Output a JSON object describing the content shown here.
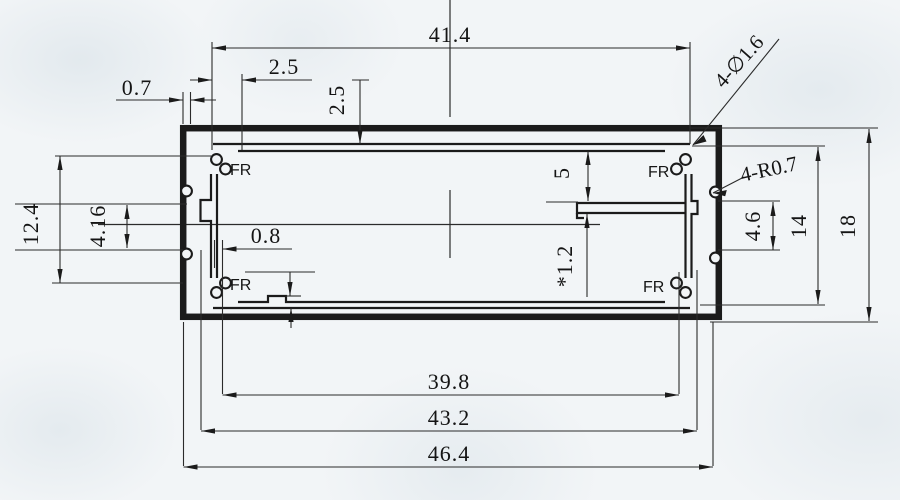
{
  "drawing": {
    "title": "aluminum extrusion enclosure profile cross-section",
    "labels": {
      "corner_boss": "FR"
    },
    "dims": {
      "top_width": "41.4",
      "top_inset": "2.5",
      "top_depth": "2.5",
      "wall_thickness": "0.7",
      "corner_holes": "4-∅1.6",
      "side_ribs": "4-R0.7",
      "left_inner_height": "12.4",
      "rib_gap": "4.16",
      "slot_offset": "5",
      "bottom_wall": "0.8",
      "pcb_slot": "*1.2",
      "rib_offset": "4.6",
      "inner_height": "14",
      "overall_height": "18",
      "opening_width": "39.8",
      "liner_width": "43.2",
      "overall_width": "46.4"
    },
    "colors": {
      "line": "#1b1b1b",
      "paper": "#f2f5f7"
    }
  }
}
